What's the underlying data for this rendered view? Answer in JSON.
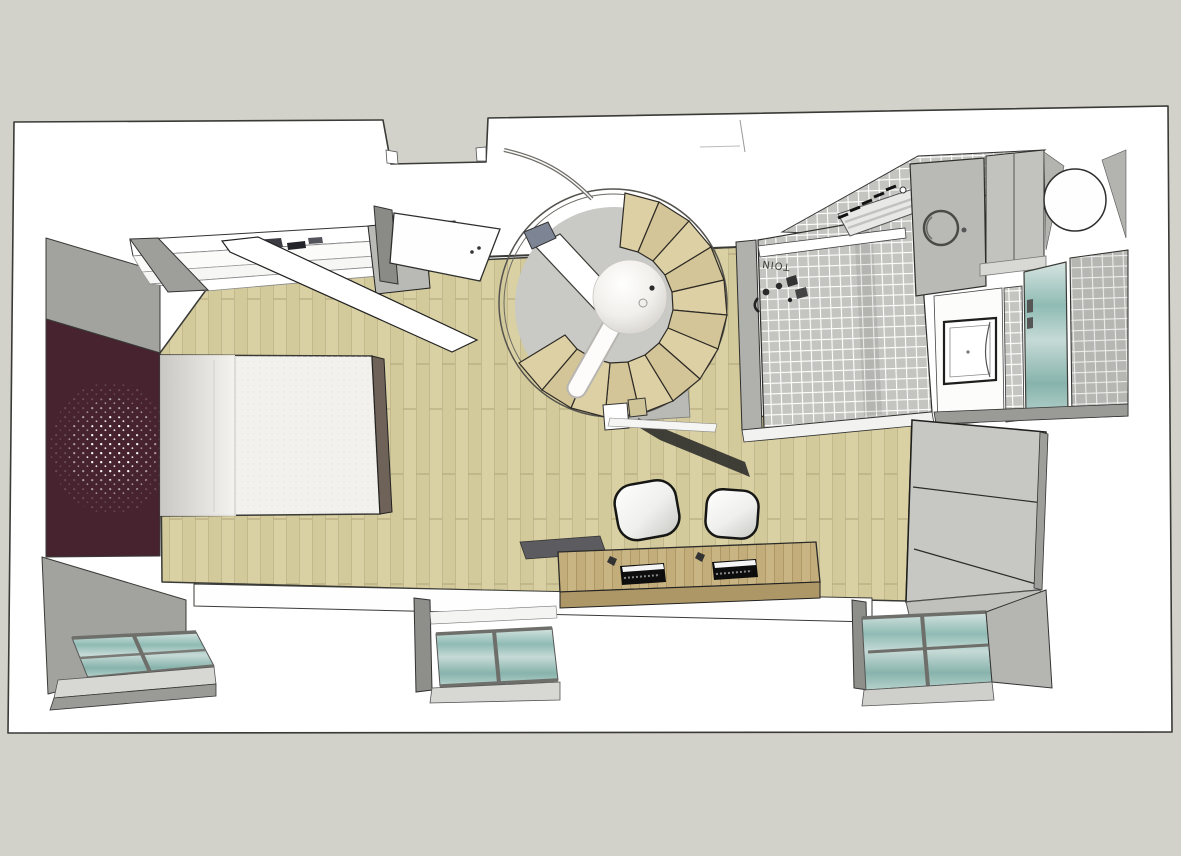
{
  "scene": {
    "description": "3D top-down rendering of a studio apartment floor plan (SketchUp style)",
    "bathroom": {
      "fixture_label": "TOIN"
    }
  },
  "colors": {
    "background": "#d2d2ca",
    "plan_white": "#ffffff",
    "outline": "#3a3a37",
    "wood_floor": "#d9d1a3",
    "wood_plank_line": "#c3b98c",
    "accent_wall": "#46232f",
    "speckle": "#ffffff",
    "wall_gray": "#a2a29e",
    "wall_gray_dark": "#8e8e8a",
    "wall_gray_light": "#c6c6c2",
    "tile": "#c4c4c0",
    "grout": "#ffffff",
    "stair_step": "#ddd0a4",
    "stair_disc": "#c9c9c5",
    "glass_teal": "#8fbbb4",
    "glass_teal_light": "#d7e4e1",
    "mattress": "#f3f1ed",
    "pillow_gray": "#c6c4c0",
    "bed_frame": "#6f6258",
    "desk_wood": "#c9b584",
    "desk_front": "#ad9766",
    "keyboard_black": "#0d0d0d",
    "chair_white": "#ffffff",
    "shadow": "#2e2e2b",
    "appliance_gray": "#b9b9b5",
    "wardrobe_gray": "#c7c7c4",
    "sill_gray": "#d7d7d3"
  },
  "objects": {
    "bedroom": [
      "accent-wall-with-speckles",
      "double-bed",
      "closet-with-open-door",
      "wood-parquet-floor"
    ],
    "center": [
      "spiral-staircase",
      "entry-door"
    ],
    "bathroom": [
      "tiled-walls",
      "towel-radiator",
      "washing-machine",
      "wall-cabinets",
      "round-table",
      "washbasin",
      "shower-glass-door"
    ],
    "right": [
      "tall-wardrobe"
    ],
    "south": [
      "desk-with-two-chairs",
      "window-left",
      "window-center",
      "window-right"
    ]
  }
}
